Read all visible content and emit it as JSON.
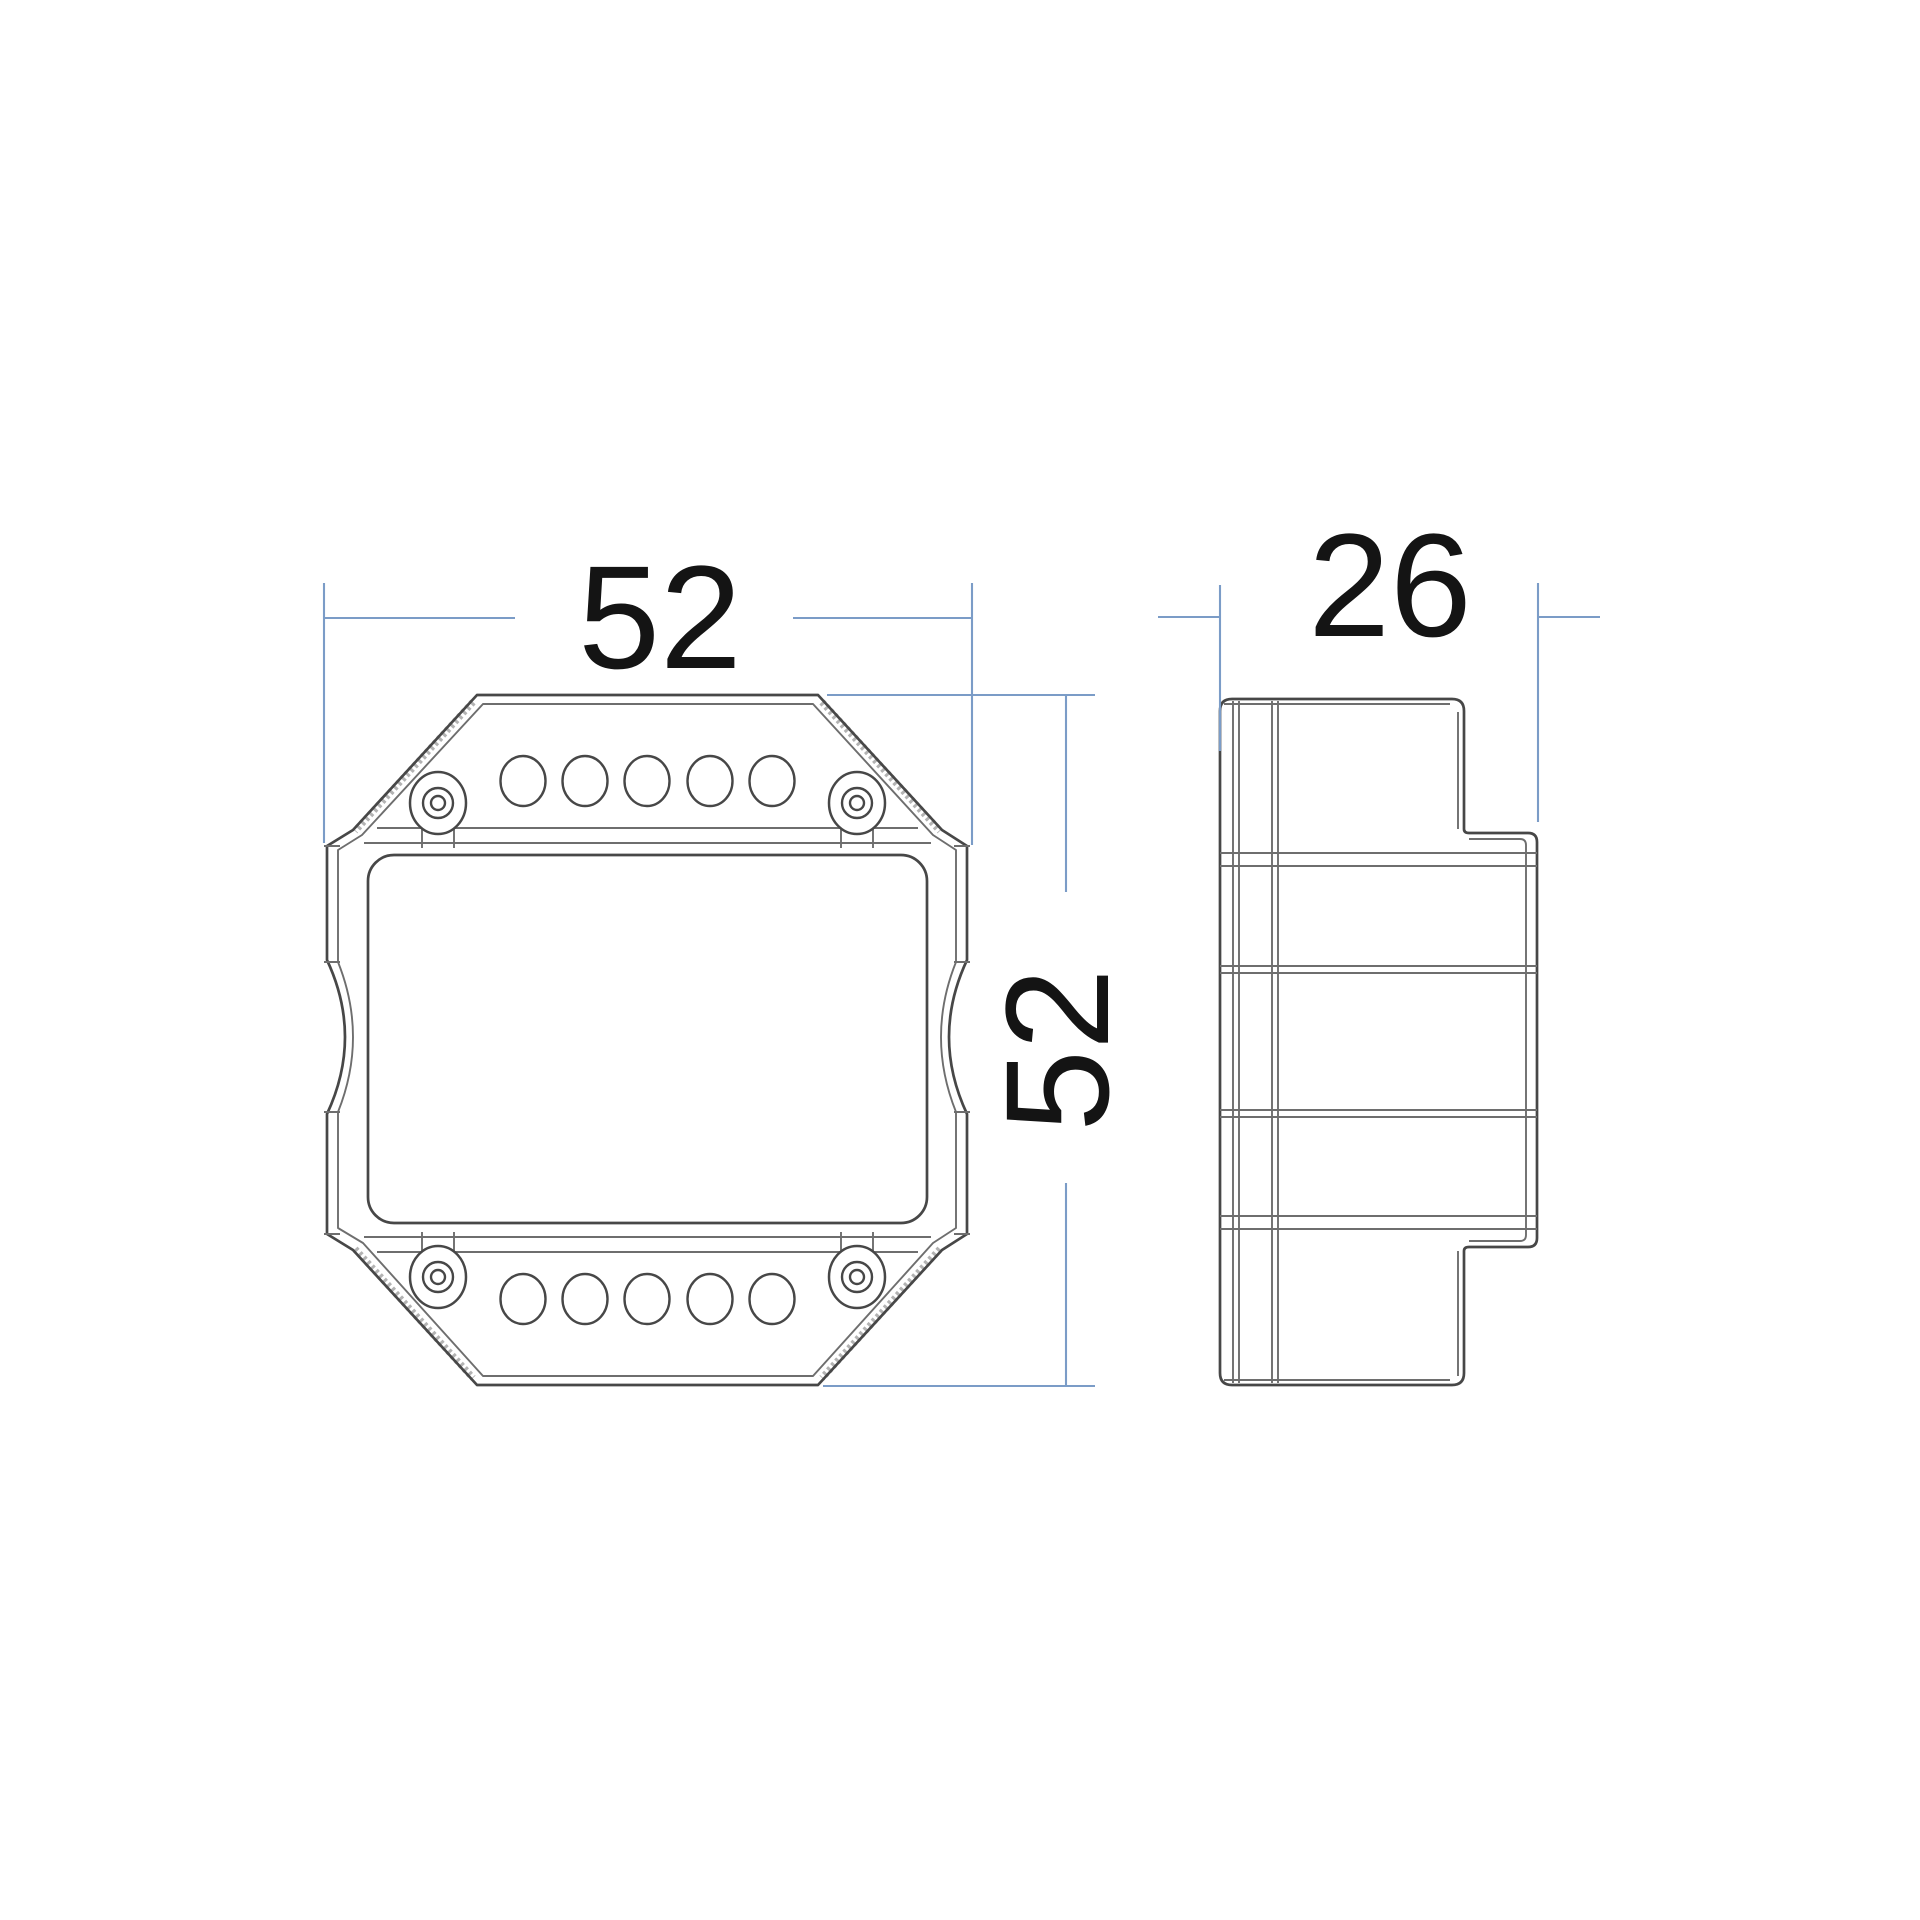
{
  "page": {
    "background": "#ffffff"
  },
  "colors": {
    "line": "#474747",
    "line_secondary": "#6e6e6e",
    "hatch": "#b3b3b3",
    "dimension_line": "#7b9cc7",
    "label_text": "#141414"
  },
  "drawing": {
    "type": "technical-dimension-drawing",
    "views": [
      {
        "id": "front-view",
        "terminal_holes_top": 5,
        "terminal_holes_bottom": 5,
        "screw_posts": 4
      },
      {
        "id": "side-view"
      }
    ],
    "dimensions": {
      "front_width": {
        "value": "52"
      },
      "front_height": {
        "value": "52"
      },
      "side_depth": {
        "value": "26"
      }
    }
  }
}
